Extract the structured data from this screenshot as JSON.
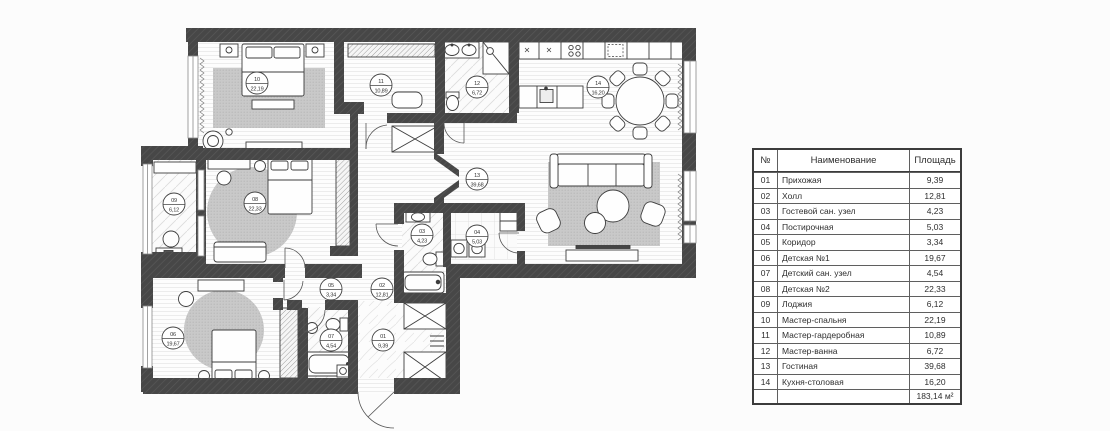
{
  "rooms": [
    {
      "num": "01",
      "name": "Прихожая",
      "area": "9,39"
    },
    {
      "num": "02",
      "name": "Холл",
      "area": "12,81"
    },
    {
      "num": "03",
      "name": "Гостевой сан. узел",
      "area": "4,23"
    },
    {
      "num": "04",
      "name": "Постирочная",
      "area": "5,03"
    },
    {
      "num": "05",
      "name": "Коридор",
      "area": "3,34"
    },
    {
      "num": "06",
      "name": "Детская №1",
      "area": "19,67"
    },
    {
      "num": "07",
      "name": "Детский сан. узел",
      "area": "4,54"
    },
    {
      "num": "08",
      "name": "Детская №2",
      "area": "22,33"
    },
    {
      "num": "09",
      "name": "Лоджия",
      "area": "6,12"
    },
    {
      "num": "10",
      "name": "Мастер-спальня",
      "area": "22,19"
    },
    {
      "num": "11",
      "name": "Мастер-гардеробная",
      "area": "10,89"
    },
    {
      "num": "12",
      "name": "Мастер-ванна",
      "area": "6,72"
    },
    {
      "num": "13",
      "name": "Гостиная",
      "area": "39,68"
    },
    {
      "num": "14",
      "name": "Кухня-столовая",
      "area": "16,20"
    }
  ],
  "table": {
    "headers": {
      "num": "№",
      "name": "Наименование",
      "area": "Площадь"
    },
    "total_area": "183,14 м²"
  },
  "colors": {
    "wall": "#474747",
    "floor_line": "#e6e6e6",
    "rug": "#cacaca",
    "line": "#3d3d3d"
  }
}
